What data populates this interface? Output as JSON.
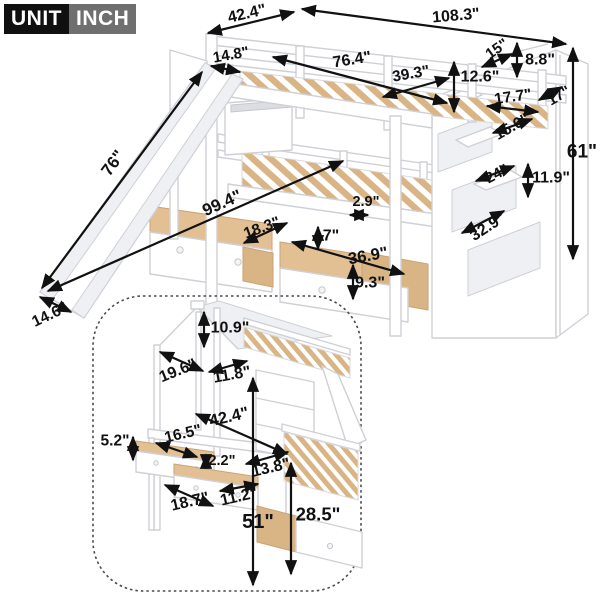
{
  "unit_badge": {
    "unit": "UNIT",
    "inch": "INCH"
  },
  "colors": {
    "badge_unit_bg": "#101010",
    "badge_inch_bg": "#6f6f6f",
    "badge_text": "#ffffff",
    "dimension_color": "#111111",
    "furniture_outline": "#cfd0d6",
    "furniture_fill": "#ffffff",
    "wood_slat": "#d9b586",
    "background": "#ffffff"
  },
  "main_diagram": {
    "name": "bunk-bed-with-slide-drawers-and-storage-staircase",
    "dimensions": [
      {
        "id": "top-rail-width",
        "text": "42.4\"",
        "label": {
          "x": 247,
          "y": 14,
          "rot": -13,
          "size": 16
        },
        "arrow": {
          "x1": 208,
          "y1": 33,
          "x2": 294,
          "y2": 12
        }
      },
      {
        "id": "total-length",
        "text": "108.3\"",
        "label": {
          "x": 456,
          "y": 16,
          "rot": -5,
          "size": 16
        },
        "arrow": {
          "x1": 302,
          "y1": 9,
          "x2": 566,
          "y2": 44
        }
      },
      {
        "id": "slide-top-width",
        "text": "14.8\"",
        "label": {
          "x": 231,
          "y": 55,
          "rot": -10,
          "size": 15
        },
        "arrow": {
          "x1": 211,
          "y1": 66,
          "x2": 240,
          "y2": 72
        }
      },
      {
        "id": "upper-mattress-length",
        "text": "76.4\"",
        "label": {
          "x": 352,
          "y": 60,
          "rot": -9,
          "size": 16
        },
        "arrow": {
          "x1": 273,
          "y1": 57,
          "x2": 447,
          "y2": 103
        }
      },
      {
        "id": "upper-mattress-width",
        "text": "39.3\"",
        "label": {
          "x": 411,
          "y": 74,
          "rot": -10,
          "size": 15.5
        },
        "arrow": {
          "x1": 383,
          "y1": 97,
          "x2": 449,
          "y2": 78
        }
      },
      {
        "id": "guardrail-height",
        "text": "12.6\"",
        "label": {
          "x": 480,
          "y": 77,
          "rot": 0,
          "size": 16
        },
        "arrow": {
          "x1": 454,
          "y1": 62,
          "x2": 454,
          "y2": 112
        }
      },
      {
        "id": "stair-opening",
        "text": "15\"",
        "label": {
          "x": 497,
          "y": 49,
          "rot": -35,
          "size": 15
        },
        "arrow": {
          "x1": 482,
          "y1": 67,
          "x2": 512,
          "y2": 54
        }
      },
      {
        "id": "stair-rail-height",
        "text": "8.8\"",
        "label": {
          "x": 540,
          "y": 60,
          "rot": 0,
          "size": 16
        },
        "arrow": {
          "x1": 517,
          "y1": 43,
          "x2": 517,
          "y2": 77
        }
      },
      {
        "id": "step-depth",
        "text": "17.7\"",
        "label": {
          "x": 513,
          "y": 97,
          "rot": -8,
          "size": 15.5
        },
        "arrow": {
          "x1": 487,
          "y1": 106,
          "x2": 538,
          "y2": 112
        }
      },
      {
        "id": "stair-width",
        "text": "17\"",
        "label": {
          "x": 559,
          "y": 96,
          "rot": -30,
          "size": 15
        },
        "arrow": {
          "x1": 539,
          "y1": 100,
          "x2": 562,
          "y2": 87
        }
      },
      {
        "id": "shelf-top-width",
        "text": "15.6\"",
        "label": {
          "x": 512,
          "y": 127,
          "rot": -30,
          "size": 15.5
        },
        "arrow": {
          "x1": 493,
          "y1": 133,
          "x2": 532,
          "y2": 119
        }
      },
      {
        "id": "overall-height",
        "text": "61\"",
        "label": {
          "x": 582,
          "y": 152,
          "rot": 0,
          "size": 19
        },
        "arrow": {
          "x1": 573,
          "y1": 48,
          "x2": 573,
          "y2": 259
        }
      },
      {
        "id": "shelf-mid-width",
        "text": "24\"",
        "label": {
          "x": 497,
          "y": 174,
          "rot": -28,
          "size": 15
        },
        "arrow": {
          "x1": 476,
          "y1": 181,
          "x2": 514,
          "y2": 166
        }
      },
      {
        "id": "shelf-mid-height",
        "text": "11.9\"",
        "label": {
          "x": 551,
          "y": 178,
          "rot": 0,
          "size": 16
        },
        "arrow": {
          "x1": 528,
          "y1": 164,
          "x2": 528,
          "y2": 197
        }
      },
      {
        "id": "shelf-bottom-width",
        "text": "32.9\"",
        "label": {
          "x": 488,
          "y": 227,
          "rot": -33,
          "size": 16
        },
        "arrow": {
          "x1": 462,
          "y1": 233,
          "x2": 504,
          "y2": 211
        }
      },
      {
        "id": "slat-gap",
        "text": "2.9\"",
        "label": {
          "x": 366,
          "y": 202,
          "rot": 0,
          "size": 14.5
        },
        "arrow": {
          "x1": 350,
          "y1": 215,
          "x2": 368,
          "y2": 215
        }
      },
      {
        "id": "length-with-slide",
        "text": "99.4\"",
        "label": {
          "x": 222,
          "y": 203,
          "rot": -24,
          "size": 17
        },
        "arrow": {
          "x1": 48,
          "y1": 291,
          "x2": 343,
          "y2": 161
        }
      },
      {
        "id": "slide-length",
        "text": "76\"",
        "label": {
          "x": 113,
          "y": 163,
          "rot": -54,
          "size": 17
        },
        "arrow": {
          "x1": 202,
          "y1": 72,
          "x2": 42,
          "y2": 288
        }
      },
      {
        "id": "small-drawer-width",
        "text": "18.3\"",
        "label": {
          "x": 262,
          "y": 228,
          "rot": -20,
          "size": 15.5
        },
        "arrow": {
          "x1": 244,
          "y1": 243,
          "x2": 287,
          "y2": 223
        }
      },
      {
        "id": "drawer-depth",
        "text": "7\"",
        "label": {
          "x": 331,
          "y": 236,
          "rot": 0,
          "size": 16
        },
        "arrow": {
          "x1": 318,
          "y1": 227,
          "x2": 318,
          "y2": 249
        }
      },
      {
        "id": "long-drawer-width",
        "text": "36.9\"",
        "label": {
          "x": 368,
          "y": 256,
          "rot": -10,
          "size": 16.5
        },
        "arrow": {
          "x1": 292,
          "y1": 242,
          "x2": 404,
          "y2": 274
        }
      },
      {
        "id": "drawer-front-height",
        "text": "9.3\"",
        "label": {
          "x": 370,
          "y": 283,
          "rot": 0,
          "size": 16
        },
        "arrow": {
          "x1": 353,
          "y1": 265,
          "x2": 353,
          "y2": 299
        }
      },
      {
        "id": "slide-end-width",
        "text": "14.6\"",
        "label": {
          "x": 50,
          "y": 315,
          "rot": -25,
          "size": 15.5
        },
        "arrow": {
          "x1": 40,
          "y1": 297,
          "x2": 71,
          "y2": 312
        }
      }
    ]
  },
  "inset_diagram": {
    "name": "house-loft-bed-with-desk-and-storage",
    "dimensions": [
      {
        "id": "roof-height",
        "text": "10.9\"",
        "label": {
          "x": 230,
          "y": 328,
          "rot": 0,
          "size": 16
        },
        "arrow": {
          "x1": 204,
          "y1": 312,
          "x2": 204,
          "y2": 347
        }
      },
      {
        "id": "roof-slope-left",
        "text": "19.6\"",
        "label": {
          "x": 178,
          "y": 371,
          "rot": -22,
          "size": 16
        },
        "arrow": {
          "x1": 160,
          "y1": 352,
          "x2": 203,
          "y2": 371
        }
      },
      {
        "id": "roof-slope-right",
        "text": "11.8\"",
        "label": {
          "x": 232,
          "y": 375,
          "rot": -10,
          "size": 16
        },
        "arrow": {
          "x1": 209,
          "y1": 372,
          "x2": 247,
          "y2": 361
        }
      },
      {
        "id": "bed-length",
        "text": "42.4\"",
        "label": {
          "x": 229,
          "y": 417,
          "rot": -13,
          "size": 16.5
        },
        "arrow": {
          "x1": 196,
          "y1": 414,
          "x2": 287,
          "y2": 454
        }
      },
      {
        "id": "desk-depth",
        "text": "16.5\"",
        "label": {
          "x": 183,
          "y": 434,
          "rot": -13,
          "size": 15.5
        },
        "arrow": {
          "x1": 156,
          "y1": 443,
          "x2": 197,
          "y2": 457
        }
      },
      {
        "id": "desk-drawer-height",
        "text": "5.2\"",
        "label": {
          "x": 115,
          "y": 441,
          "rot": 0,
          "size": 15.5
        },
        "arrow": {
          "x1": 133,
          "y1": 437,
          "x2": 133,
          "y2": 460
        }
      },
      {
        "id": "desk-top-thickness",
        "text": "2.2\"",
        "label": {
          "x": 222,
          "y": 461,
          "rot": 0,
          "size": 14.5
        },
        "arrow": {
          "x1": 206,
          "y1": 455,
          "x2": 206,
          "y2": 468
        }
      },
      {
        "id": "desk-clearance",
        "text": "13.8\"",
        "label": {
          "x": 271,
          "y": 468,
          "rot": -13,
          "size": 16
        },
        "arrow": {
          "x1": 246,
          "y1": 464,
          "x2": 288,
          "y2": 452
        }
      },
      {
        "id": "desk-width",
        "text": "18.7\"",
        "label": {
          "x": 190,
          "y": 502,
          "rot": -13,
          "size": 16
        },
        "arrow": {
          "x1": 165,
          "y1": 485,
          "x2": 213,
          "y2": 506
        }
      },
      {
        "id": "drawer-inner-width",
        "text": "11.2\"",
        "label": {
          "x": 239,
          "y": 497,
          "rot": -13,
          "size": 16
        },
        "arrow": {
          "x1": 220,
          "y1": 491,
          "x2": 258,
          "y2": 484
        }
      },
      {
        "id": "loft-height",
        "text": "51\"",
        "label": {
          "x": 258,
          "y": 522,
          "rot": 0,
          "size": 20
        },
        "arrow": {
          "x1": 253,
          "y1": 378,
          "x2": 253,
          "y2": 585
        }
      },
      {
        "id": "under-bed-height",
        "text": "28.5\"",
        "label": {
          "x": 318,
          "y": 514,
          "rot": 0,
          "size": 18.5
        },
        "arrow": {
          "x1": 291,
          "y1": 463,
          "x2": 291,
          "y2": 574
        }
      }
    ]
  }
}
